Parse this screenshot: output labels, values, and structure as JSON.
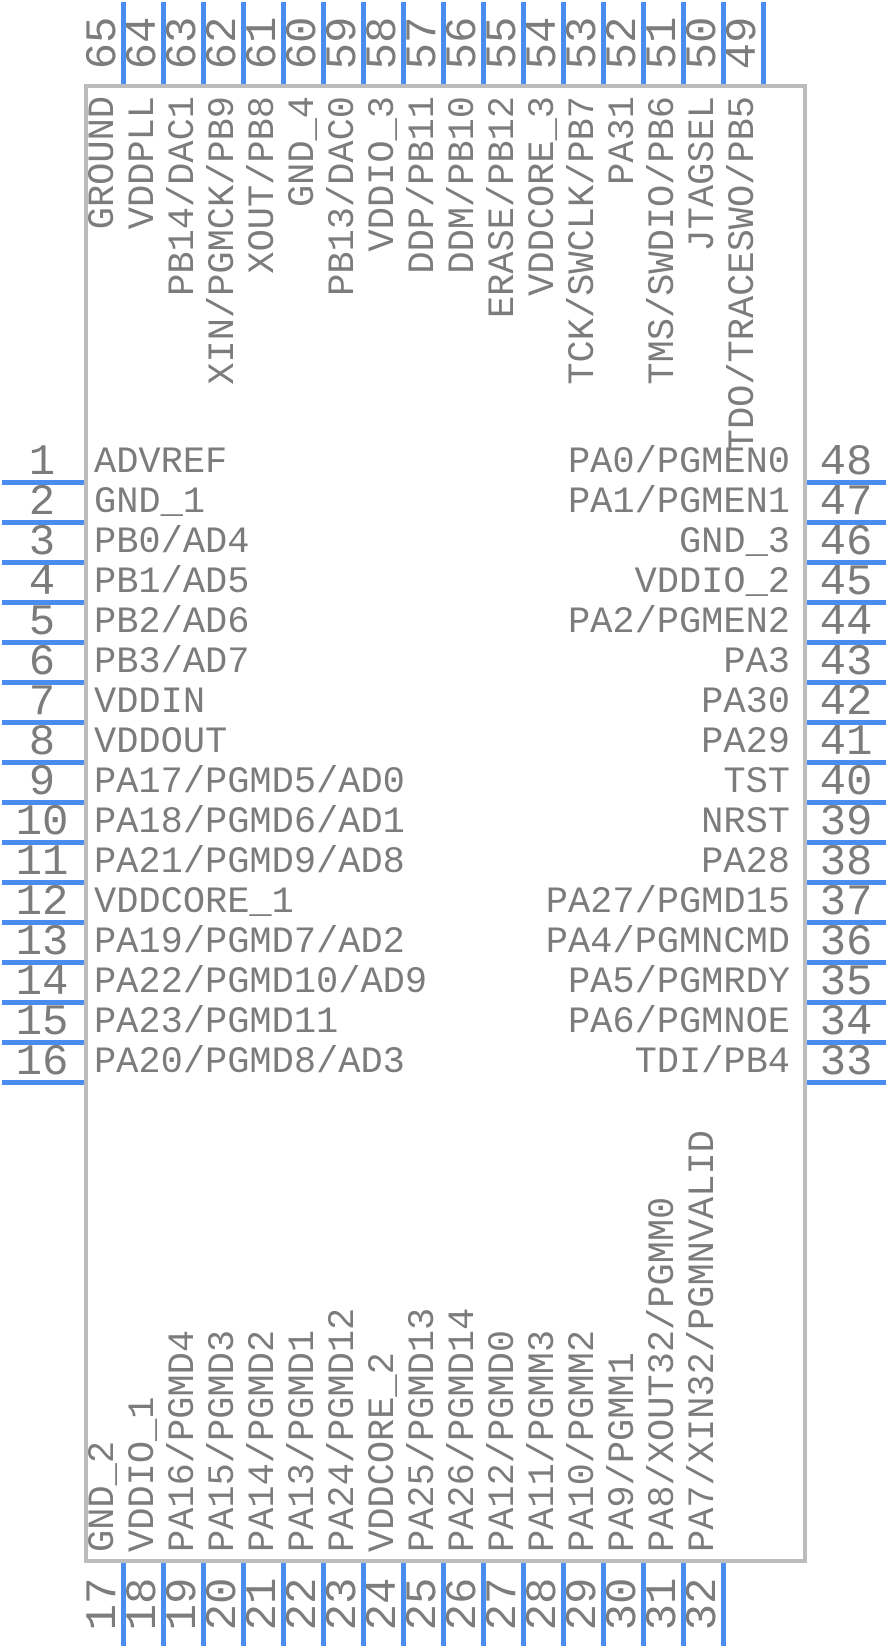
{
  "diagram": {
    "type": "ic-pinout-symbol",
    "colors": {
      "pin_blue": "#4a8cf0",
      "body_border": "#bcbcbc",
      "label_text": "#7c7c7c",
      "background": "#ffffff"
    },
    "top_pins": [
      {
        "number": "65",
        "label": "GROUND"
      },
      {
        "number": "64",
        "label": "VDDPLL"
      },
      {
        "number": "63",
        "label": "PB14/DAC1"
      },
      {
        "number": "62",
        "label": "XIN/PGMCK/PB9"
      },
      {
        "number": "61",
        "label": "XOUT/PB8"
      },
      {
        "number": "60",
        "label": "GND_4"
      },
      {
        "number": "59",
        "label": "PB13/DAC0"
      },
      {
        "number": "58",
        "label": "VDDIO_3"
      },
      {
        "number": "57",
        "label": "DDP/PB11"
      },
      {
        "number": "56",
        "label": "DDM/PB10"
      },
      {
        "number": "55",
        "label": "ERASE/PB12"
      },
      {
        "number": "54",
        "label": "VDDCORE_3"
      },
      {
        "number": "53",
        "label": "TCK/SWCLK/PB7"
      },
      {
        "number": "52",
        "label": "PA31"
      },
      {
        "number": "51",
        "label": "TMS/SWDIO/PB6"
      },
      {
        "number": "50",
        "label": "JTAGSEL"
      },
      {
        "number": "49",
        "label": "TDO/TRACESWO/PB5"
      }
    ],
    "left_pins": [
      {
        "number": "1",
        "label": "ADVREF"
      },
      {
        "number": "2",
        "label": "GND_1"
      },
      {
        "number": "3",
        "label": "PB0/AD4"
      },
      {
        "number": "4",
        "label": "PB1/AD5"
      },
      {
        "number": "5",
        "label": "PB2/AD6"
      },
      {
        "number": "6",
        "label": "PB3/AD7"
      },
      {
        "number": "7",
        "label": "VDDIN"
      },
      {
        "number": "8",
        "label": "VDDOUT"
      },
      {
        "number": "9",
        "label": "PA17/PGMD5/AD0"
      },
      {
        "number": "10",
        "label": "PA18/PGMD6/AD1"
      },
      {
        "number": "11",
        "label": "PA21/PGMD9/AD8"
      },
      {
        "number": "12",
        "label": "VDDCORE_1"
      },
      {
        "number": "13",
        "label": "PA19/PGMD7/AD2"
      },
      {
        "number": "14",
        "label": "PA22/PGMD10/AD9"
      },
      {
        "number": "15",
        "label": "PA23/PGMD11"
      },
      {
        "number": "16",
        "label": "PA20/PGMD8/AD3"
      }
    ],
    "right_pins": [
      {
        "number": "48",
        "label": "PA0/PGMEN0"
      },
      {
        "number": "47",
        "label": "PA1/PGMEN1"
      },
      {
        "number": "46",
        "label": "GND_3"
      },
      {
        "number": "45",
        "label": "VDDIO_2"
      },
      {
        "number": "44",
        "label": "PA2/PGMEN2"
      },
      {
        "number": "43",
        "label": "PA3"
      },
      {
        "number": "42",
        "label": "PA30"
      },
      {
        "number": "41",
        "label": "PA29"
      },
      {
        "number": "40",
        "label": "TST"
      },
      {
        "number": "39",
        "label": "NRST"
      },
      {
        "number": "38",
        "label": "PA28"
      },
      {
        "number": "37",
        "label": "PA27/PGMD15"
      },
      {
        "number": "36",
        "label": "PA4/PGMNCMD"
      },
      {
        "number": "35",
        "label": "PA5/PGMRDY"
      },
      {
        "number": "34",
        "label": "PA6/PGMNOE"
      },
      {
        "number": "33",
        "label": "TDI/PB4"
      }
    ],
    "bottom_pins": [
      {
        "number": "17",
        "label": "GND_2"
      },
      {
        "number": "18",
        "label": "VDDIO_1"
      },
      {
        "number": "19",
        "label": "PA16/PGMD4"
      },
      {
        "number": "20",
        "label": "PA15/PGMD3"
      },
      {
        "number": "21",
        "label": "PA14/PGMD2"
      },
      {
        "number": "22",
        "label": "PA13/PGMD1"
      },
      {
        "number": "23",
        "label": "PA24/PGMD12"
      },
      {
        "number": "24",
        "label": "VDDCORE_2"
      },
      {
        "number": "25",
        "label": "PA25/PGMD13"
      },
      {
        "number": "26",
        "label": "PA26/PGMD14"
      },
      {
        "number": "27",
        "label": "PA12/PGMD0"
      },
      {
        "number": "28",
        "label": "PA11/PGMM3"
      },
      {
        "number": "29",
        "label": "PA10/PGMM2"
      },
      {
        "number": "30",
        "label": "PA9/PGMM1"
      },
      {
        "number": "31",
        "label": "PA8/XOUT32/PGMM0"
      },
      {
        "number": "32",
        "label": "PA7/XIN32/PGMNVALID"
      }
    ]
  }
}
